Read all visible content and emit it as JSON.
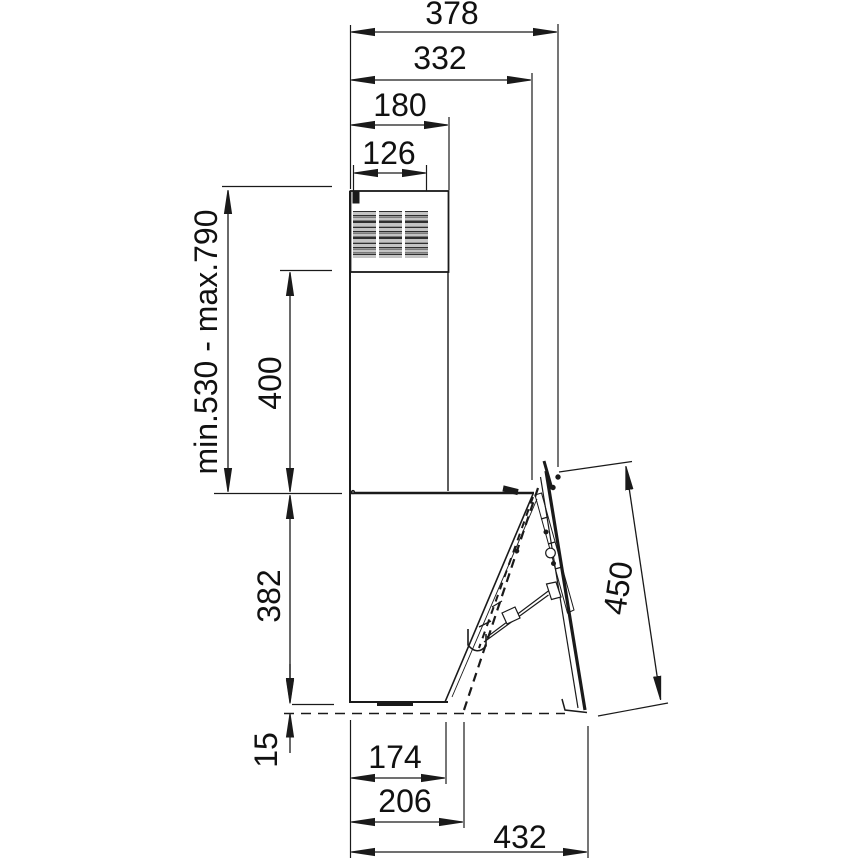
{
  "drawing": {
    "type": "technical-dimension-drawing",
    "subject_view": "side-elevation",
    "colors": {
      "line": "#1a1a1a",
      "secondary_line": "#999999",
      "reference_dash": "#555555",
      "background": "#ffffff",
      "text": "#111111"
    },
    "dimensions": {
      "overall_depth_top": "378",
      "body_top_depth": "332",
      "chimney_width": "180",
      "air_outlet_width": "126",
      "chimney_height_range": "min.530 - max.790",
      "telescopic_section_height": "400",
      "body_height": "382",
      "bottom_gap": "15",
      "body_bottom_depth": "174",
      "bottom_depth_with_panel": "206",
      "overall_bottom_depth": "432",
      "front_panel_length": "450"
    }
  }
}
